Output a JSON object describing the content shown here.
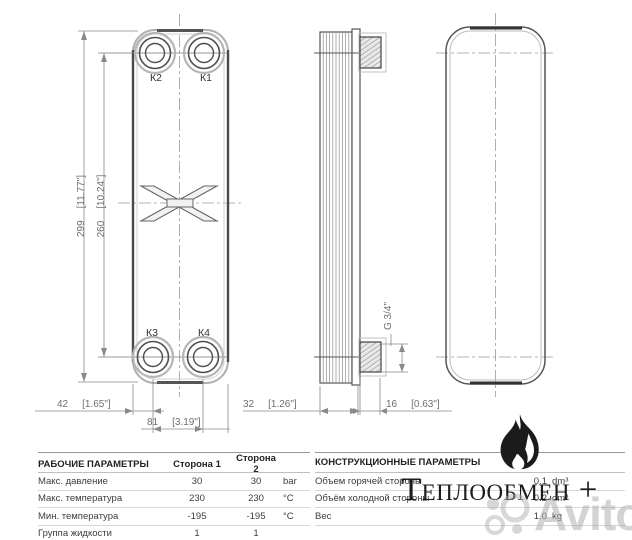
{
  "drawing": {
    "ports": {
      "k2": "К2",
      "k1": "К1",
      "k3": "К3",
      "k4": "К4"
    },
    "dims": {
      "h_total": {
        "mm": "299",
        "inch": "[11.77\"]"
      },
      "h_ports": {
        "mm": "260",
        "inch": "[10.24\"]"
      },
      "edge": {
        "mm": "42",
        "inch": "[1.65\"]"
      },
      "ports_span": {
        "mm": "81",
        "inch": "[3.19\"]"
      },
      "pack": {
        "mm": "32",
        "inch": "[1.26\"]"
      },
      "conn": {
        "mm": "16",
        "inch": "[0.63\"]"
      },
      "thread": "G 3/4\""
    }
  },
  "tables": {
    "working": {
      "title": "РАБОЧИЕ ПАРАМЕТРЫ",
      "col1": "Сторона 1",
      "col2": "Сторона 2",
      "rows": [
        {
          "label": "Макс. давление",
          "v1": "30",
          "v2": "30",
          "unit": "bar"
        },
        {
          "label": "Макс. температура",
          "v1": "230",
          "v2": "230",
          "unit": "°C"
        },
        {
          "label": "Мин. температура",
          "v1": "-195",
          "v2": "-195",
          "unit": "°C"
        },
        {
          "label": "Группа жидкости",
          "v1": "1",
          "v2": "1",
          "unit": ""
        }
      ]
    },
    "construction": {
      "title": "КОНСТРУКЦИОННЫЕ ПАРАМЕТРЫ",
      "rows": [
        {
          "label": "Объем горячей стороны",
          "value": "0.1",
          "unit": "dm³"
        },
        {
          "label": "Объём холодной стороны",
          "value": "0.2",
          "unit": "dm³"
        },
        {
          "label": "Вес",
          "value": "1.0",
          "unit": "kg"
        }
      ]
    }
  },
  "branding": {
    "logo_text": "Теплообмен +",
    "watermark_text": "Avito",
    "accent_color": "#1b1b1b",
    "watermark_color": "#b0b0b0"
  }
}
